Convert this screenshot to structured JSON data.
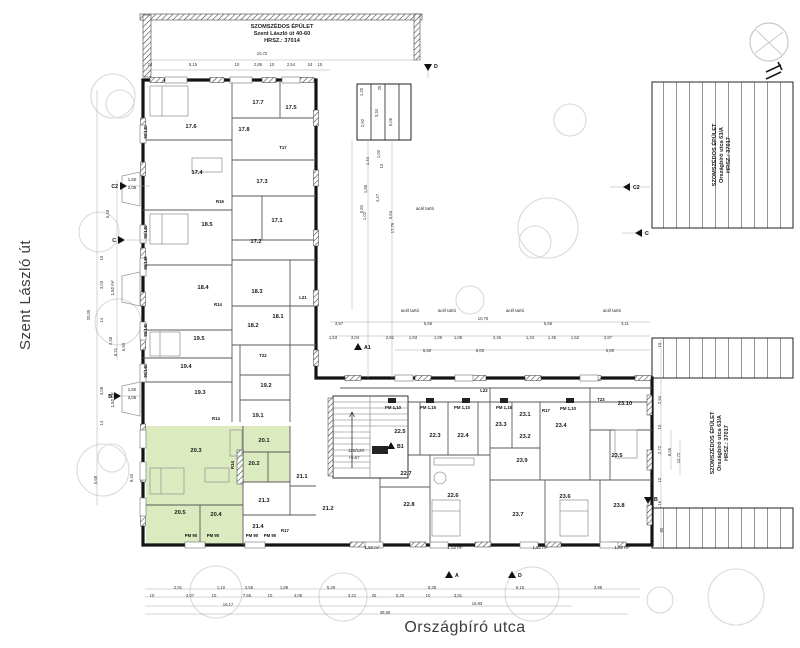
{
  "streets": {
    "left": "Szent László út",
    "bottom": "Országbíró utca"
  },
  "neighbors": {
    "top": {
      "line1": "SZOMSZÉDOS ÉPÜLET",
      "line2": "Szent László út 40-60",
      "line3": "HRSZ.: 37014"
    },
    "right": {
      "line1": "SZOMSZÉDOS ÉPÜLET",
      "line2": "Országbíró utca 63/A",
      "line3": "HRSZ.: 37017"
    }
  },
  "colors": {
    "highlight": "#dcebbf",
    "wall": "#141414",
    "tree": "#d9d9d9",
    "dim_text": "#333333"
  },
  "plan": {
    "rooms": [
      {
        "id": "17.1",
        "x": 277,
        "y": 222
      },
      {
        "id": "17.2",
        "x": 256,
        "y": 243
      },
      {
        "id": "17.3",
        "x": 262,
        "y": 183
      },
      {
        "id": "17.4",
        "x": 197,
        "y": 174
      },
      {
        "id": "17.5",
        "x": 291,
        "y": 109
      },
      {
        "id": "17.6",
        "x": 191,
        "y": 128
      },
      {
        "id": "17.7",
        "x": 258,
        "y": 104
      },
      {
        "id": "17.8",
        "x": 244,
        "y": 131
      },
      {
        "id": "18.1",
        "x": 278,
        "y": 318
      },
      {
        "id": "18.2",
        "x": 253,
        "y": 327
      },
      {
        "id": "18.3",
        "x": 257,
        "y": 293
      },
      {
        "id": "18.4",
        "x": 203,
        "y": 289
      },
      {
        "id": "18.5",
        "x": 207,
        "y": 226
      },
      {
        "id": "19.1",
        "x": 258,
        "y": 417
      },
      {
        "id": "19.2",
        "x": 266,
        "y": 387
      },
      {
        "id": "19.3",
        "x": 200,
        "y": 394
      },
      {
        "id": "19.4",
        "x": 186,
        "y": 368
      },
      {
        "id": "19.5",
        "x": 199,
        "y": 340
      },
      {
        "id": "20.1",
        "x": 264,
        "y": 442,
        "hl": true
      },
      {
        "id": "20.2",
        "x": 254,
        "y": 465,
        "hl": true
      },
      {
        "id": "20.3",
        "x": 196,
        "y": 452,
        "hl": true
      },
      {
        "id": "20.4",
        "x": 216,
        "y": 516,
        "hl": true
      },
      {
        "id": "20.5",
        "x": 180,
        "y": 514,
        "hl": true
      },
      {
        "id": "21.1",
        "x": 302,
        "y": 478
      },
      {
        "id": "21.2",
        "x": 328,
        "y": 510
      },
      {
        "id": "21.3",
        "x": 264,
        "y": 502
      },
      {
        "id": "21.4",
        "x": 258,
        "y": 528
      },
      {
        "id": "22.3",
        "x": 435,
        "y": 437
      },
      {
        "id": "22.4",
        "x": 463,
        "y": 437
      },
      {
        "id": "22.5",
        "x": 400,
        "y": 433
      },
      {
        "id": "22.6",
        "x": 453,
        "y": 497
      },
      {
        "id": "22.7",
        "x": 406,
        "y": 475
      },
      {
        "id": "22.8",
        "x": 409,
        "y": 506
      },
      {
        "id": "23.1",
        "x": 525,
        "y": 416
      },
      {
        "id": "23.2",
        "x": 525,
        "y": 438
      },
      {
        "id": "23.3",
        "x": 501,
        "y": 426
      },
      {
        "id": "23.4",
        "x": 561,
        "y": 427
      },
      {
        "id": "23.5",
        "x": 617,
        "y": 457
      },
      {
        "id": "23.6",
        "x": 565,
        "y": 498
      },
      {
        "id": "23.7",
        "x": 518,
        "y": 516
      },
      {
        "id": "23.8",
        "x": 619,
        "y": 507
      },
      {
        "id": "23.9",
        "x": 522,
        "y": 462
      },
      {
        "id": "23.10",
        "x": 625,
        "y": 405
      }
    ],
    "tags": [
      {
        "t": "T17",
        "x": 283,
        "y": 149
      },
      {
        "t": "T22",
        "x": 263,
        "y": 357
      },
      {
        "t": "T23",
        "x": 601,
        "y": 401
      },
      {
        "t": "L21",
        "x": 303,
        "y": 299
      },
      {
        "t": "L22",
        "x": 484,
        "y": 392
      },
      {
        "t": "R16",
        "x": 220,
        "y": 203
      },
      {
        "t": "R14",
        "x": 218,
        "y": 306
      },
      {
        "t": "R14",
        "x": 216,
        "y": 420
      },
      {
        "t": "R14",
        "x": 234,
        "y": 465,
        "r": -90
      },
      {
        "t": "R17",
        "x": 546,
        "y": 412
      },
      {
        "t": "R17",
        "x": 285,
        "y": 532
      },
      {
        "t": "PM 90",
        "x": 191,
        "y": 537
      },
      {
        "t": "PM 90",
        "x": 213,
        "y": 537
      },
      {
        "t": "PM 90",
        "x": 252,
        "y": 537
      },
      {
        "t": "PM 90",
        "x": 270,
        "y": 537
      },
      {
        "t": "PM 1,10",
        "x": 393,
        "y": 409
      },
      {
        "t": "PM 1,15",
        "x": 428,
        "y": 409
      },
      {
        "t": "PM 1,10",
        "x": 462,
        "y": 409
      },
      {
        "t": "PM 1,15",
        "x": 504,
        "y": 409
      },
      {
        "t": "PM 1,10",
        "x": 568,
        "y": 410
      },
      {
        "t": "90/140",
        "x": 147,
        "y": 132,
        "r": -90
      },
      {
        "t": "90/140",
        "x": 147,
        "y": 232,
        "r": -90
      },
      {
        "t": "90/140",
        "x": 147,
        "y": 263,
        "r": -90
      },
      {
        "t": "90/140",
        "x": 147,
        "y": 330,
        "r": -90
      },
      {
        "t": "90/140",
        "x": 147,
        "y": 371,
        "r": -90
      }
    ],
    "dims": [
      {
        "t": "10,72",
        "x": 262,
        "y": 55
      },
      {
        "t": "24",
        "x": 150,
        "y": 66
      },
      {
        "t": "5,15",
        "x": 193,
        "y": 66
      },
      {
        "t": "10",
        "x": 237,
        "y": 66
      },
      {
        "t": "2,85",
        "x": 258,
        "y": 66
      },
      {
        "t": "10",
        "x": 272,
        "y": 66
      },
      {
        "t": "2,54",
        "x": 291,
        "y": 66
      },
      {
        "t": "24",
        "x": 310,
        "y": 66
      },
      {
        "t": "15",
        "x": 320,
        "y": 66
      },
      {
        "t": "15",
        "x": 103,
        "y": 258,
        "r": -90
      },
      {
        "t": "3,03",
        "x": 103,
        "y": 285,
        "r": -90
      },
      {
        "t": "20,05",
        "x": 90,
        "y": 315,
        "r": -90
      },
      {
        "t": "14",
        "x": 103,
        "y": 320,
        "r": -90
      },
      {
        "t": "2,48",
        "x": 112,
        "y": 341,
        "r": -90
      },
      {
        "t": "8,21",
        "x": 117,
        "y": 352,
        "r": -90
      },
      {
        "t": "3,08",
        "x": 103,
        "y": 391,
        "r": -90
      },
      {
        "t": "14",
        "x": 103,
        "y": 423,
        "r": -90
      },
      {
        "t": "5,48",
        "x": 109,
        "y": 214,
        "r": -90
      },
      {
        "t": "6,93",
        "x": 125,
        "y": 347,
        "r": -90
      },
      {
        "t": "5,68",
        "x": 97,
        "y": 480,
        "r": -90
      },
      {
        "t": "9,40",
        "x": 133,
        "y": 478,
        "r": -90
      },
      {
        "t": "15",
        "x": 661,
        "y": 345,
        "r": -90
      },
      {
        "t": "2,94",
        "x": 661,
        "y": 400,
        "r": -90
      },
      {
        "t": "10",
        "x": 661,
        "y": 427,
        "r": -90
      },
      {
        "t": "2,72",
        "x": 661,
        "y": 450,
        "r": -90
      },
      {
        "t": "8,06",
        "x": 671,
        "y": 452,
        "r": -90
      },
      {
        "t": "10,72",
        "x": 680,
        "y": 458,
        "r": -90
      },
      {
        "t": "10",
        "x": 661,
        "y": 480,
        "r": -90
      },
      {
        "t": "1,16",
        "x": 661,
        "y": 505,
        "r": -90
      },
      {
        "t": "80",
        "x": 663,
        "y": 530,
        "r": -90
      },
      {
        "t": "2,91",
        "x": 178,
        "y": 589
      },
      {
        "t": "1,10",
        "x": 221,
        "y": 589
      },
      {
        "t": "2,56",
        "x": 249,
        "y": 589
      },
      {
        "t": "1,89",
        "x": 284,
        "y": 589
      },
      {
        "t": "5,28",
        "x": 331,
        "y": 589
      },
      {
        "t": "8,38",
        "x": 432,
        "y": 589
      },
      {
        "t": "6,16",
        "x": 520,
        "y": 589
      },
      {
        "t": "3,98",
        "x": 598,
        "y": 589
      },
      {
        "t": "10",
        "x": 152,
        "y": 597
      },
      {
        "t": "3,07",
        "x": 190,
        "y": 597
      },
      {
        "t": "10",
        "x": 214,
        "y": 597
      },
      {
        "t": "7,65",
        "x": 247,
        "y": 597
      },
      {
        "t": "10",
        "x": 270,
        "y": 597
      },
      {
        "t": "4,09",
        "x": 298,
        "y": 597
      },
      {
        "t": "3,22",
        "x": 352,
        "y": 597
      },
      {
        "t": "25",
        "x": 374,
        "y": 597
      },
      {
        "t": "5,20",
        "x": 400,
        "y": 597
      },
      {
        "t": "10",
        "x": 428,
        "y": 597
      },
      {
        "t": "3,81",
        "x": 458,
        "y": 597
      },
      {
        "t": "16,17",
        "x": 228,
        "y": 606
      },
      {
        "t": "16,93",
        "x": 477,
        "y": 605
      },
      {
        "t": "38,59",
        "x": 385,
        "y": 614
      },
      {
        "t": "3,97",
        "x": 339,
        "y": 325
      },
      {
        "t": "5,59",
        "x": 428,
        "y": 325
      },
      {
        "t": "10,76",
        "x": 483,
        "y": 320
      },
      {
        "t": "5,58",
        "x": 548,
        "y": 325
      },
      {
        "t": "4,11",
        "x": 625,
        "y": 325
      },
      {
        "t": "1,53",
        "x": 333,
        "y": 339
      },
      {
        "t": "3,04",
        "x": 355,
        "y": 339
      },
      {
        "t": "2,61",
        "x": 390,
        "y": 339
      },
      {
        "t": "1,93",
        "x": 413,
        "y": 339
      },
      {
        "t": "1,06",
        "x": 438,
        "y": 339
      },
      {
        "t": "1,09",
        "x": 458,
        "y": 339
      },
      {
        "t": "2,45",
        "x": 497,
        "y": 339
      },
      {
        "t": "1,43",
        "x": 530,
        "y": 339
      },
      {
        "t": "1,45",
        "x": 552,
        "y": 339
      },
      {
        "t": "1,52",
        "x": 575,
        "y": 339
      },
      {
        "t": "2,87",
        "x": 608,
        "y": 339
      },
      {
        "t": "5,59",
        "x": 427,
        "y": 352
      },
      {
        "t": "5,00",
        "x": 480,
        "y": 352
      },
      {
        "t": "5,80",
        "x": 610,
        "y": 352
      },
      {
        "t": "1,00",
        "x": 380,
        "y": 154,
        "r": -90
      },
      {
        "t": "1,44",
        "x": 369,
        "y": 161,
        "r": -90
      },
      {
        "t": "10",
        "x": 383,
        "y": 166,
        "r": -90
      },
      {
        "t": "1,85",
        "x": 367,
        "y": 189,
        "r": -90
      },
      {
        "t": "4,47",
        "x": 379,
        "y": 198,
        "r": -90
      },
      {
        "t": "5,84",
        "x": 363,
        "y": 209,
        "r": -90
      },
      {
        "t": "1,02",
        "x": 366,
        "y": 216,
        "r": -90
      },
      {
        "t": "5,64",
        "x": 392,
        "y": 215,
        "r": -90
      },
      {
        "t": "17,76",
        "x": 394,
        "y": 228,
        "r": -90
      },
      {
        "t": "1,20",
        "x": 363,
        "y": 92,
        "r": -90
      },
      {
        "t": "25",
        "x": 381,
        "y": 88,
        "r": -90
      },
      {
        "t": "2,92",
        "x": 364,
        "y": 123,
        "r": -90
      },
      {
        "t": "3,34",
        "x": 378,
        "y": 113,
        "r": -90
      },
      {
        "t": "5,06",
        "x": 392,
        "y": 122,
        "r": -90
      }
    ],
    "annotations": [
      {
        "t": "acél tartó",
        "x": 410,
        "y": 312
      },
      {
        "t": "acél tartó",
        "x": 447,
        "y": 312
      },
      {
        "t": "acél tartó",
        "x": 515,
        "y": 312
      },
      {
        "t": "acél tartó",
        "x": 612,
        "y": 312
      },
      {
        "t": "acél tartó",
        "x": 425,
        "y": 210
      },
      {
        "t": "125/120",
        "x": 356,
        "y": 452
      },
      {
        "t": "+5,67",
        "x": 354,
        "y": 459
      },
      {
        "t": "1,52 m²",
        "x": 372,
        "y": 549
      },
      {
        "t": "1,52 m²",
        "x": 455,
        "y": 549
      },
      {
        "t": "1,52 m²",
        "x": 540,
        "y": 549
      },
      {
        "t": "1,52 m²",
        "x": 622,
        "y": 549
      },
      {
        "t": "1,52 m²",
        "x": 114,
        "y": 288,
        "r": -90
      },
      {
        "t": "1,52 m²",
        "x": 114,
        "y": 400,
        "r": -90
      },
      {
        "t": "1,50",
        "x": 132,
        "y": 181
      },
      {
        "t": "2,06",
        "x": 132,
        "y": 189
      },
      {
        "t": "1,50",
        "x": 132,
        "y": 391
      },
      {
        "t": "2,06",
        "x": 132,
        "y": 399
      }
    ],
    "markers": [
      {
        "label": "C2",
        "x": 120,
        "y": 186,
        "dir": "right"
      },
      {
        "label": "C",
        "x": 118,
        "y": 240,
        "dir": "right"
      },
      {
        "label": "B",
        "x": 114,
        "y": 396,
        "dir": "right"
      },
      {
        "label": "D",
        "x": 428,
        "y": 64,
        "dir": "down"
      },
      {
        "label": "A",
        "x": 449,
        "y": 578,
        "dir": "up"
      },
      {
        "label": "D",
        "x": 512,
        "y": 578,
        "dir": "up"
      },
      {
        "label": "C2",
        "x": 630,
        "y": 187,
        "dir": "left"
      },
      {
        "label": "C",
        "x": 642,
        "y": 233,
        "dir": "left"
      },
      {
        "label": "B",
        "x": 648,
        "y": 497,
        "dir": "down"
      },
      {
        "label": "A1",
        "x": 358,
        "y": 350,
        "dir": "up"
      },
      {
        "label": "B1",
        "x": 391,
        "y": 449,
        "dir": "up"
      }
    ]
  }
}
